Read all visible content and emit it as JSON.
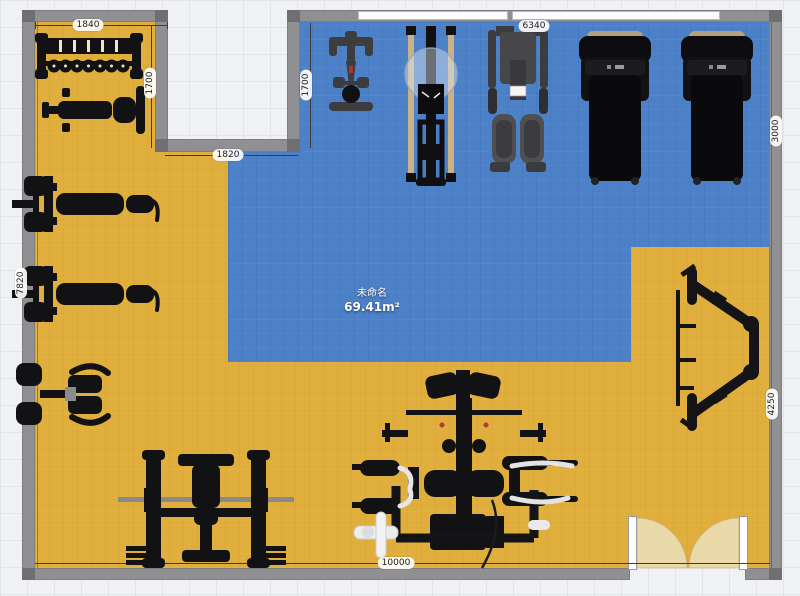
{
  "app": {
    "view": "floor-plan-editor-canvas"
  },
  "room": {
    "name": "未命名",
    "area": "69.41m²",
    "colors": {
      "floor_yellow": "#dfae3c",
      "floor_blue": "#4c80c7",
      "wall": "#909092",
      "wall_corner": "#6f6f72",
      "background": "#f0f1f3",
      "door_arc": "#ead9a8",
      "equipment": "#121214"
    }
  },
  "dims": {
    "top_left_width": "1840",
    "top_left_height": "1700",
    "notch_width": "1820",
    "hall_height": "1700",
    "hall_width": "6340",
    "right_upper": "3000",
    "right_lower": "4250",
    "left_height": "7820",
    "total_width": "10000"
  },
  "equipment": {
    "items": [
      {
        "id": "dumbbell-rack",
        "label": "dumbbell rack"
      },
      {
        "id": "flat-bench",
        "label": "flat bench"
      },
      {
        "id": "bench-press-station-1",
        "label": "bench press station"
      },
      {
        "id": "bench-press-station-2",
        "label": "bench press station"
      },
      {
        "id": "seated-press-machine",
        "label": "seated press machine"
      },
      {
        "id": "olympic-bench-press",
        "label": "olympic bench press with barbell"
      },
      {
        "id": "multi-station-home-gym",
        "label": "multi-station home gym"
      },
      {
        "id": "incline-frame",
        "label": "incline rack frame"
      },
      {
        "id": "spin-bike",
        "label": "spin bike"
      },
      {
        "id": "rowing-machine",
        "label": "rowing machine"
      },
      {
        "id": "cable-gym",
        "label": "cable gym machine"
      },
      {
        "id": "treadmill-1",
        "label": "treadmill"
      },
      {
        "id": "treadmill-2",
        "label": "treadmill"
      }
    ]
  }
}
